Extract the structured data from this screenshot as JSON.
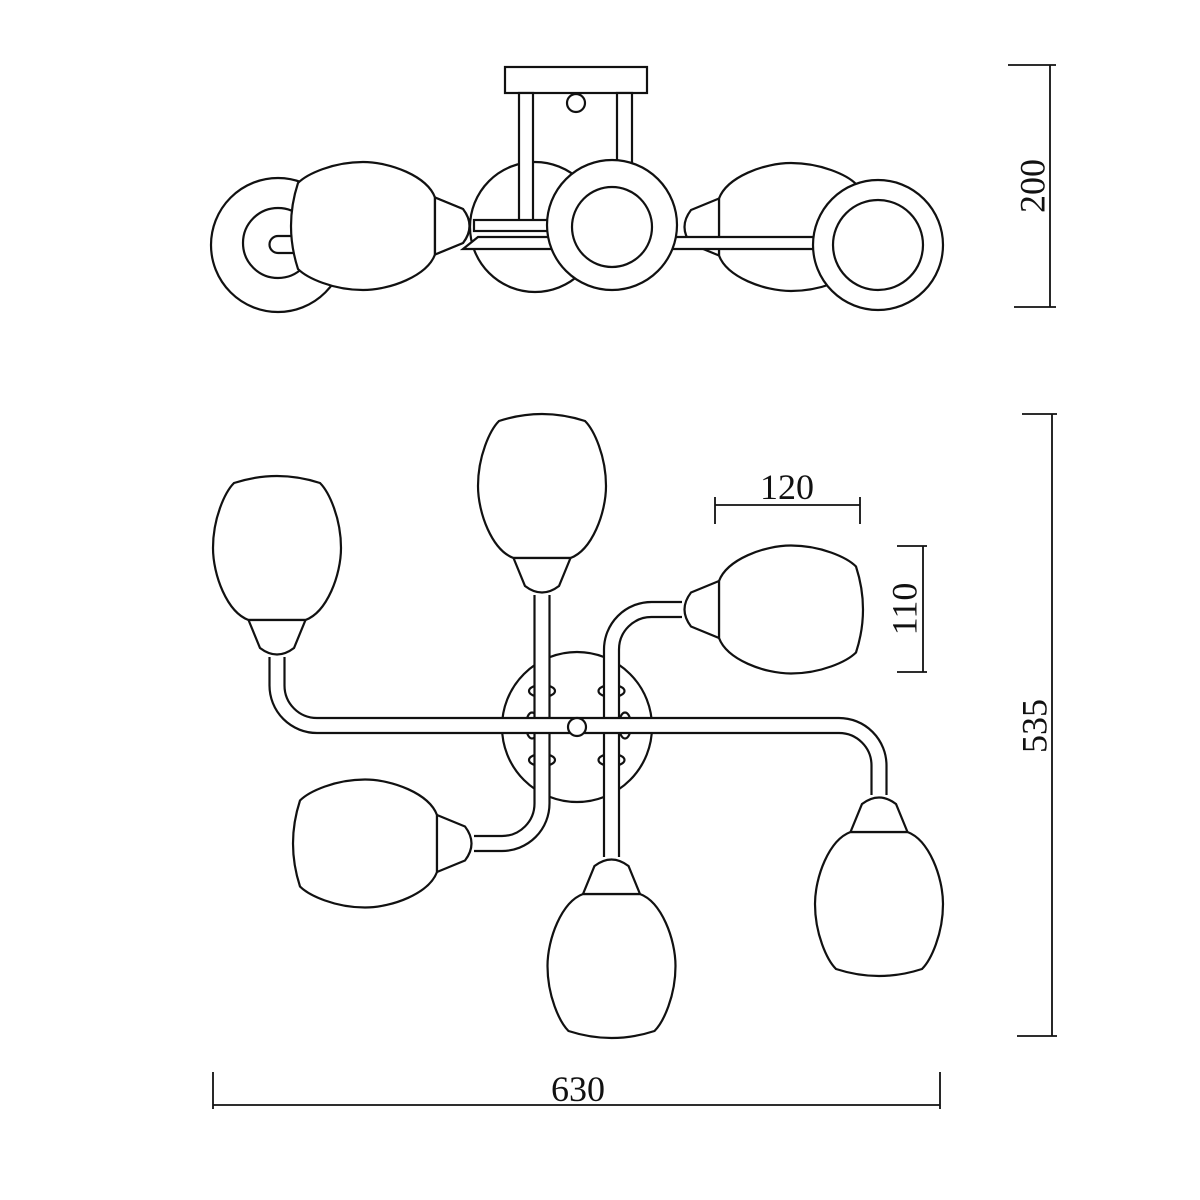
{
  "drawing": {
    "type": "technical-drawing-ceiling-lamp-6-shades",
    "views": {
      "top": "side-elevation",
      "bottom": "plan-view"
    },
    "dimensions": {
      "side_height": "200",
      "plan_height": "535",
      "plan_width": "630",
      "shade_width": "120",
      "shade_height": "110"
    },
    "colors": {
      "line": "#111111",
      "background": "#ffffff"
    }
  }
}
